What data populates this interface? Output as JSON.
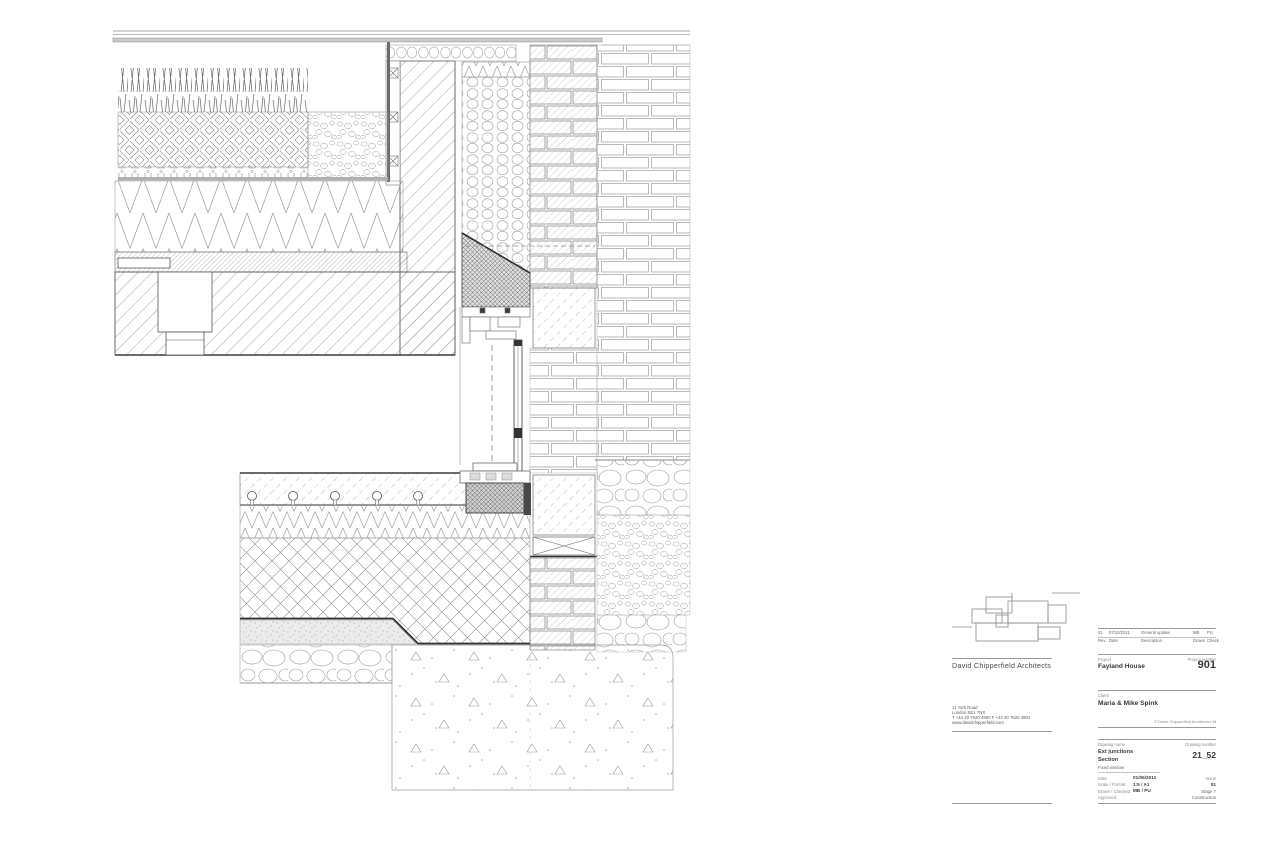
{
  "sheet": {
    "background": "#ffffff",
    "line_color": "#555555",
    "description": "Architectural construction detail sheet: external wall junction sections at roof parapet and ground floor with fixed window"
  },
  "title_block": {
    "location_plan_icon": "site-plan-outline",
    "firm_name": "David Chipperfield Architects",
    "address_lines": [
      "11 York Road",
      "London SE1 7NX",
      "T +44 20 7620 4800    F +44 20 7620 4801",
      "www.davidchipperfield.com"
    ],
    "revisions": {
      "entries": [
        {
          "rev": "01",
          "date": "07/10/2011",
          "description": "General update",
          "drawn": "MB",
          "check": "PU"
        }
      ],
      "headers": {
        "rev": "Rev.",
        "date": "Date",
        "description": "Description",
        "drawn": "Drawn",
        "check": "Check"
      }
    },
    "project": {
      "label": "Project",
      "value": "Fayland House"
    },
    "project_number": {
      "label": "Project number",
      "value": "901"
    },
    "client": {
      "label": "Client",
      "value": "Maria & Mike Spink"
    },
    "copyright": "© David Chipperfield Architects Ltd",
    "drawing_name": {
      "label": "Drawing name",
      "lines": [
        "Ext junctions",
        "Section",
        "Fixed window"
      ]
    },
    "drawing_number": {
      "label": "Drawing number",
      "value": "21_52"
    },
    "meta": {
      "date": {
        "label": "Date",
        "value": "01/06/2011"
      },
      "scale_format": {
        "label": "Scale / Format",
        "value": "1:5 / A1"
      },
      "drawn_checked": {
        "label": "Drawn / Checked",
        "value": "MB / PU"
      },
      "approved": {
        "label": "Approved",
        "value": ""
      },
      "issue_label": "Issue",
      "issue_value": "01",
      "stage": "Stage 7",
      "status": "Construction"
    }
  }
}
